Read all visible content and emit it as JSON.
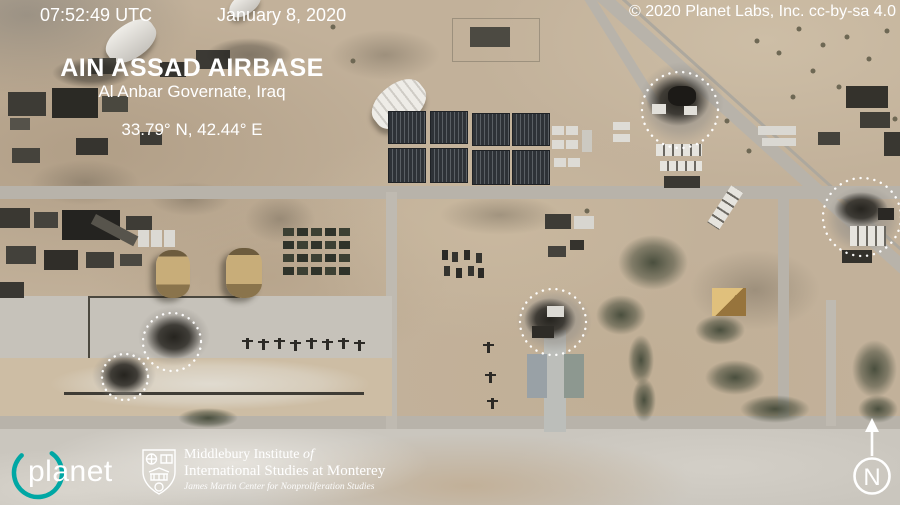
{
  "header": {
    "timestamp": "07:52:49 UTC",
    "date": "January 8, 2020",
    "credit": "© 2020 Planet Labs, Inc. cc-by-sa 4.0"
  },
  "title_block": {
    "title": "AIN ASSAD AIRBASE",
    "subtitle": "Al Anbar Governate, Iraq",
    "coordinates": "33.79° N, 42.44° E"
  },
  "footer": {
    "planet_wordmark": "planet",
    "institute_line1": "Middlebury Institute",
    "institute_line1_italic": "of",
    "institute_line2": "International Studies at Monterey",
    "institute_line3": "James Martin Center for Nonproliferation Studies"
  },
  "compass": {
    "north_label": "N"
  },
  "annotations": {
    "marker_style": "white dotted circle",
    "count": 5,
    "color": "#ffffff"
  },
  "colors": {
    "planet_teal": "#00a7a4",
    "desert_tan": "#c2b19a"
  }
}
